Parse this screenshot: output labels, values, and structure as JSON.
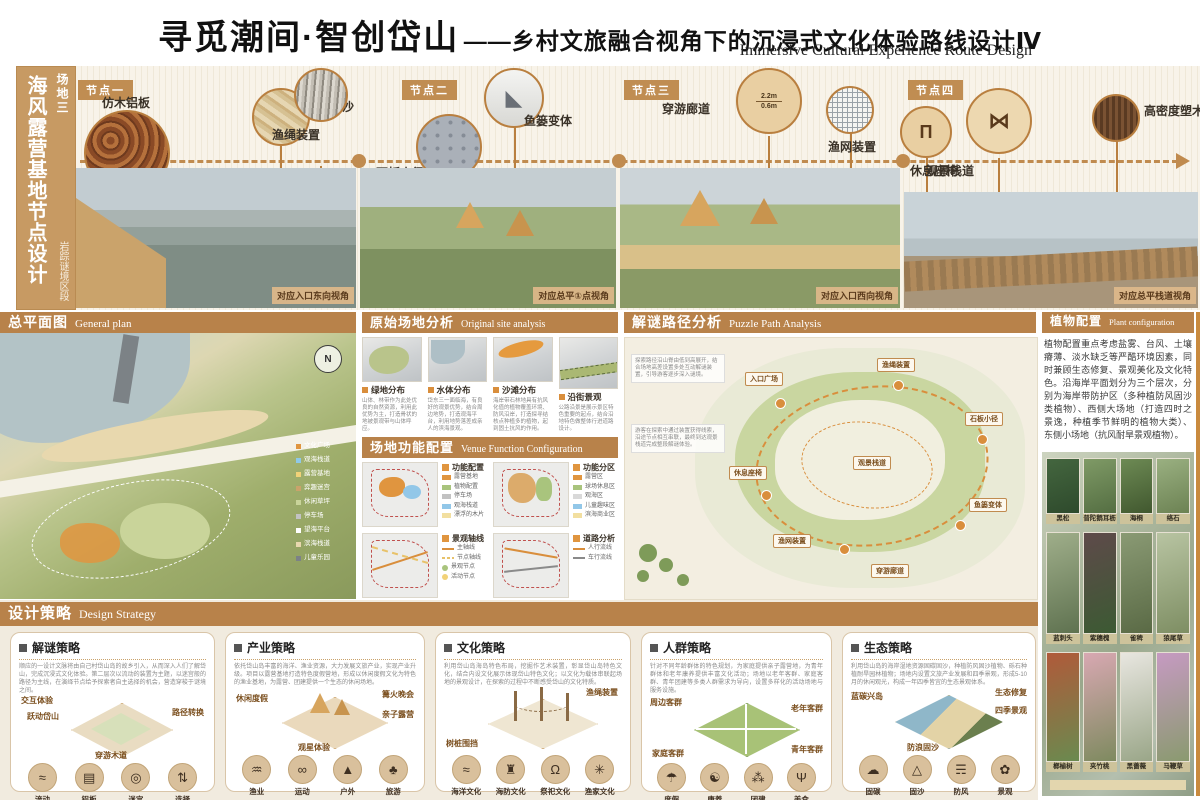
{
  "header": {
    "title": "寻觅潮间·智创岱山",
    "subtitle": "——乡村文旅融合视角下的沉浸式文化体验路线设计Ⅳ",
    "subtitle_en": "Immersive Cultural Experience Route Design"
  },
  "sidebar": {
    "site": "场地三",
    "title": "海风露营基地节点设计",
    "section": "岩踪谜境区段"
  },
  "nodes": [
    {
      "tag": "节点一",
      "materials": [
        "仿木铝板",
        "铁板沙",
        "渔绳装置"
      ],
      "caption": "对应入口东向视角"
    },
    {
      "tag": "节点二",
      "materials": [
        "石板小径",
        "鱼篓变体"
      ],
      "caption": "对应总平①点视角"
    },
    {
      "tag": "节点三",
      "materials": [
        "穿游廊道",
        "渔网装置",
        "休息座椅"
      ],
      "dims": [
        "2.2m",
        "0.6m"
      ],
      "caption": "对应入口西向视角"
    },
    {
      "tag": "节点四",
      "materials": [
        "观景栈道",
        "高密度塑木"
      ],
      "caption": "对应总平栈道视角"
    }
  ],
  "general_plan": {
    "title": "总平面图",
    "title_en": "General plan",
    "north": "N",
    "legend": [
      "文化广场",
      "观海栈道",
      "露营基地",
      "弈趣迷宫",
      "休闲草坪",
      "停车场",
      "望海平台",
      "滨海栈道",
      "儿童乐园"
    ]
  },
  "site_analysis": {
    "title": "原始场地分析",
    "title_en": "Original site analysis",
    "maps": [
      {
        "label": "绿地分布",
        "desc": "山体、林带作为此处优良的自然资源，利用此优势为主，打造骨状的地被景观带与山体呼应。"
      },
      {
        "label": "水体分布",
        "desc": "岱东三一面临海，有良好的观景优势，结合周边地势，打造观海平台，利用地势落差成亲人的滨海景观。"
      },
      {
        "label": "沙滩分布",
        "desc": "海岸带石林地具有抗风化值的植物覆盖环境、防风沿岸，打造探寻结核点种植多的植物，起到固土抗风的作用。"
      },
      {
        "label": "沿街景观",
        "desc": "公路沿景是展示景区特色重要的起点，结合沿地特色做整体行进道路设计。"
      }
    ]
  },
  "venue": {
    "title": "场地功能配置",
    "title_en": "Venue Function Configuration",
    "quadrants": [
      {
        "name": "功能配置",
        "items": [
          {
            "label": "露营基地",
            "color": "#e0953f"
          },
          {
            "label": "植物配置",
            "color": "#a9c47d"
          },
          {
            "label": "停车场",
            "color": "#c2c2c2"
          },
          {
            "label": "观海栈道",
            "color": "#92c7e8"
          },
          {
            "label": "漂浮的木片",
            "color": "#f2dfa0"
          }
        ]
      },
      {
        "name": "功能分区",
        "items": [
          {
            "label": "露营区",
            "color": "#e0953f"
          },
          {
            "label": "球场休息区",
            "color": "#a9c47d"
          },
          {
            "label": "观海区",
            "color": "#d9d9d9"
          },
          {
            "label": "儿童趣味区",
            "color": "#92c7e8"
          },
          {
            "label": "滨海商业区",
            "color": "#f2dfa0"
          }
        ]
      },
      {
        "name": "景观轴线",
        "items": [
          {
            "label": "主轴线",
            "color": "#d98e3c"
          },
          {
            "label": "节点轴线",
            "color": "#e8c26a"
          },
          {
            "label": "景观节点",
            "color": "#a9c47d"
          },
          {
            "label": "活动节点",
            "color": "#f2d278"
          }
        ]
      },
      {
        "name": "道路分析",
        "items": [
          {
            "label": "人行流线",
            "color": "#d98e3c"
          },
          {
            "label": "车行流线",
            "color": "#8a8a8a"
          }
        ]
      }
    ]
  },
  "puzzle": {
    "title": "解谜路径分析",
    "title_en": "Puzzle Path Analysis",
    "notes": [
      "探索路径沿山脊由低到高展开，结合场地高差设置多处互动解谜装置，引导游客逐步深入谜境。",
      "游客在探索中通过装置获得线索，沿途节点相互串联，最终到达观景栈道完成整段解谜体验。"
    ],
    "chips": [
      "入口广场",
      "渔绳装置",
      "石板小径",
      "鱼篓变体",
      "穿游廊道",
      "渔网装置",
      "休息座椅",
      "观景栈道"
    ]
  },
  "plants": {
    "title": "植物配置",
    "title_en": "Plant configuration",
    "paragraph": "植物配置重点考虑盐雾、台风、土壤瘠薄、淡水缺乏等严酷环境因素，同时兼顾生态修复、景观美化及文化特色。沿海岸平面划分为三个层次，分别为海岸带防护区（多种植防风固沙类植物）、西侧大场地（打造四时之景逸，种植季节鲜明的植物大类）、东侧小场地（抗风耐旱景观植物）。",
    "rows": [
      [
        "黑松",
        "普陀鹅耳枥",
        "海桐",
        "络石"
      ],
      [
        "蓝刺头",
        "紫穗槐",
        "雀稗",
        "狼尾草"
      ],
      [
        "榔榆树",
        "夹竹桃",
        "黑蔷薇",
        "马鞭草"
      ]
    ]
  },
  "strategy": {
    "title": "设计策略",
    "title_en": "Design Strategy",
    "cards": [
      {
        "title": "解谜策略",
        "text": "顺应的一设计文脉将由自己村岱山岛的故乡引入，从而深入人们了解岱山，完成沉浸式文化体验。第二层次以流动的装置为主题，以迷宫般的路径为主线，在演绎节点给予探索者自主选择的机会，营造穿梭于谜境之间。",
        "labels": [
          "交互体验",
          "跃动岱山",
          "路径转换",
          "穿游木道"
        ],
        "icons": [
          {
            "label": "流动",
            "glyph": "≈"
          },
          {
            "label": "铝板",
            "glyph": "▤"
          },
          {
            "label": "迷宫",
            "glyph": "◎"
          },
          {
            "label": "选择",
            "glyph": "⇅"
          }
        ]
      },
      {
        "title": "产业策略",
        "text": "依托岱山岛丰富的海洋、渔业资源，大力发展文旅产业，实现产业升级。项目以露营基地打造特色度假营地，形成以休闲度假文化为特色的渔业基地，为露营、团建提供一个生态的休闲场地。",
        "labels": [
          "休闲度假",
          "篝火晚会",
          "亲子露营",
          "观星体验"
        ],
        "icons": [
          {
            "label": "渔业",
            "glyph": "♒"
          },
          {
            "label": "运动",
            "glyph": "∞"
          },
          {
            "label": "户外",
            "glyph": "▲"
          },
          {
            "label": "旅游",
            "glyph": "♣"
          }
        ]
      },
      {
        "title": "文化策略",
        "text": "利用岱山岛海岛特色布局，挖掘作艺术装置，彰显岱山岛特色文化，结合内设文化展示体现岱山特色文化；以文化为载体串联起场地的景观设计，在探索的过程中不断感受岱山的文化特质。",
        "labels": [
          "渔绳装置",
          "树桩围挡"
        ],
        "icons": [
          {
            "label": "海洋文化",
            "glyph": "≈"
          },
          {
            "label": "海防文化",
            "glyph": "♜"
          },
          {
            "label": "祭祀文化",
            "glyph": "Ω"
          },
          {
            "label": "渔家文化",
            "glyph": "✳"
          }
        ]
      },
      {
        "title": "人群策略",
        "text": "针对不同年龄群体的特色规划，为家庭提供亲子露营地，为青年群体和老年康养提供丰富文化活动；场地以老年客群、家庭客群、青年团建等多类人群需求为导向，设置多样化的活动场地与服务设施。",
        "labels": [
          "周边客群",
          "老年客群",
          "家庭客群",
          "青年客群"
        ],
        "icons": [
          {
            "label": "度假",
            "glyph": "☂"
          },
          {
            "label": "康养",
            "glyph": "☯"
          },
          {
            "label": "团建",
            "glyph": "⁂"
          },
          {
            "label": "美食",
            "glyph": "Ψ"
          }
        ]
      },
      {
        "title": "生态策略",
        "text": "利用岱山岛的海岸湿地资源固碳固沙，种植防风固沙植物、砾石种植耐旱园林植物；场地内设置文旅产业发展和四季景观，形成5-10月的休闲观光，构成一年四季皆宜的生态景观体系。",
        "labels": [
          "蓝碳兴岛",
          "生态修复",
          "四季景观",
          "防浪固沙"
        ],
        "icons": [
          {
            "label": "固碳",
            "glyph": "☁"
          },
          {
            "label": "固沙",
            "glyph": "△"
          },
          {
            "label": "防风",
            "glyph": "☴"
          },
          {
            "label": "景观",
            "glyph": "✿"
          }
        ]
      }
    ]
  }
}
